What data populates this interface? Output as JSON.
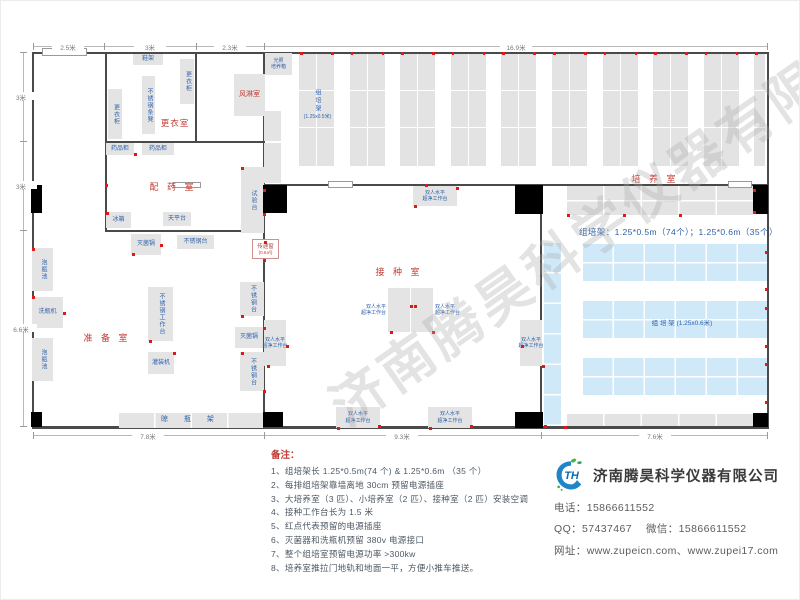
{
  "watermark": "济南腾昊科学仪器有限公司",
  "logo_text": "TH",
  "plan": {
    "walls": [
      [
        31,
        51,
        737,
        2
      ],
      [
        31,
        51,
        2,
        377
      ],
      [
        766,
        51,
        2,
        377
      ],
      [
        31,
        425,
        737,
        3
      ],
      [
        104,
        51,
        1.5,
        180
      ],
      [
        194,
        51,
        1.5,
        90
      ],
      [
        262,
        51,
        2,
        376
      ],
      [
        104,
        140,
        159,
        1.5
      ],
      [
        104,
        229,
        159,
        1.5
      ],
      [
        262,
        183,
        279,
        2
      ],
      [
        539,
        183,
        2,
        244
      ],
      [
        541,
        183,
        226,
        2
      ]
    ],
    "doors": [
      [
        41,
        47,
        45,
        8
      ],
      [
        327,
        180,
        25,
        7
      ],
      [
        727,
        180,
        24,
        7
      ],
      [
        172,
        181,
        28,
        6
      ]
    ],
    "columns": [
      [
        30,
        184,
        11,
        28
      ],
      [
        262,
        184,
        24,
        28
      ],
      [
        514,
        184,
        28,
        29
      ],
      [
        752,
        184,
        15,
        29
      ],
      [
        30,
        411,
        11,
        15
      ],
      [
        262,
        411,
        20,
        15
      ],
      [
        514,
        411,
        28,
        16
      ],
      [
        752,
        412,
        15,
        14
      ]
    ],
    "room_labels": [
      {
        "text": "更衣室",
        "x": 174,
        "y": 121,
        "fs": 8.5,
        "ls": 1
      },
      {
        "text": "配 药 室",
        "x": 172,
        "y": 184,
        "fs": 9,
        "ls": 3
      },
      {
        "text": "准 备 室",
        "x": 106,
        "y": 335,
        "fs": 9,
        "ls": 3
      },
      {
        "text": "接 种 室",
        "x": 398,
        "y": 269,
        "fs": 9,
        "ls": 3
      },
      {
        "text": "培 养 室",
        "x": 654,
        "y": 176,
        "fs": 9,
        "ls": 3
      }
    ],
    "equipment": [
      {
        "label": "鞋架",
        "x": 132,
        "y": 53,
        "w": 30,
        "h": 11
      },
      {
        "label": "更衣柜",
        "x": 179,
        "y": 58,
        "w": 14,
        "h": 45,
        "v": true
      },
      {
        "label": "不锈钢条凳",
        "x": 141,
        "y": 75,
        "w": 13,
        "h": 58,
        "v": true
      },
      {
        "label": "更衣柜",
        "x": 107,
        "y": 88,
        "w": 14,
        "h": 50,
        "v": true
      },
      {
        "label": "风淋室",
        "x": 233,
        "y": 73,
        "w": 31,
        "h": 42,
        "red": true,
        "fs": 7
      },
      {
        "label": "光照\n培养箱",
        "x": 264,
        "y": 52,
        "w": 27,
        "h": 22,
        "fs": 5
      },
      {
        "label": "",
        "x": 263,
        "y": 110,
        "w": 17,
        "h": 30
      },
      {
        "label": "",
        "x": 263,
        "y": 142,
        "w": 17,
        "h": 40
      },
      {
        "label": "药品柜",
        "x": 105,
        "y": 142,
        "w": 28,
        "h": 12
      },
      {
        "label": "药品柜",
        "x": 141,
        "y": 142,
        "w": 32,
        "h": 12
      },
      {
        "label": "试验台",
        "x": 240,
        "y": 166,
        "w": 23,
        "h": 66,
        "v": true
      },
      {
        "label": "冰箱",
        "x": 105,
        "y": 211,
        "w": 25,
        "h": 16
      },
      {
        "label": "天平台",
        "x": 162,
        "y": 211,
        "w": 28,
        "h": 14
      },
      {
        "label": "灭菌锅",
        "x": 130,
        "y": 233,
        "w": 30,
        "h": 21
      },
      {
        "label": "不锈钢台",
        "x": 176,
        "y": 234,
        "w": 37,
        "h": 14
      },
      {
        "label": "泡瓶池",
        "x": 31,
        "y": 247,
        "w": 21,
        "h": 43,
        "v": true
      },
      {
        "label": "洗瓶机",
        "x": 31,
        "y": 296,
        "w": 31,
        "h": 31
      },
      {
        "label": "泡瓶池",
        "x": 31,
        "y": 337,
        "w": 21,
        "h": 43,
        "v": true
      },
      {
        "label": "不锈钢工作台",
        "x": 147,
        "y": 286,
        "w": 25,
        "h": 54,
        "v": true
      },
      {
        "label": "灌装机",
        "x": 147,
        "y": 351,
        "w": 26,
        "h": 22
      },
      {
        "label": "不锈钢台",
        "x": 239,
        "y": 281,
        "w": 24,
        "h": 34,
        "v": true
      },
      {
        "label": "灭菌锅",
        "x": 234,
        "y": 326,
        "w": 28,
        "h": 21
      },
      {
        "label": "不锈钢台",
        "x": 239,
        "y": 351,
        "w": 24,
        "h": 39,
        "v": true
      },
      {
        "label": "晾 瓶 架",
        "x": 118,
        "y": 412,
        "w": 144,
        "h": 15,
        "shelf": true,
        "fs": 7
      },
      {
        "label": "双人水平\n超净工作台",
        "x": 412,
        "y": 185,
        "w": 44,
        "h": 20,
        "fs": 5
      },
      {
        "label": "双人水平\n超净工作台",
        "x": 387,
        "y": 287,
        "w": 22,
        "h": 44,
        "mode": "left",
        "fs": 5
      },
      {
        "label": "双人水平\n超净工作台",
        "x": 410,
        "y": 287,
        "w": 22,
        "h": 44,
        "mode": "right",
        "fs": 5
      },
      {
        "label": "双人水平\n超净工作台",
        "x": 263,
        "y": 319,
        "w": 22,
        "h": 46,
        "mode": "spill",
        "fs": 5
      },
      {
        "label": "双人水平\n超净工作台",
        "x": 519,
        "y": 319,
        "w": 22,
        "h": 46,
        "mode": "spill",
        "fs": 5
      },
      {
        "label": "双人水平\n超净工作台",
        "x": 335,
        "y": 406,
        "w": 44,
        "h": 21,
        "fs": 5
      },
      {
        "label": "双人水平\n超净工作台",
        "x": 427,
        "y": 406,
        "w": 44,
        "h": 21,
        "fs": 5
      }
    ],
    "pass_window": {
      "label": "传递窗",
      "size": "(0.6㎡)",
      "x": 251,
      "y": 238,
      "w": 27,
      "h": 20
    },
    "strips": {
      "count": 10,
      "x0": 298,
      "pitch": 50.6,
      "w": 35,
      "y": 53,
      "h": 112,
      "clip": 764
    },
    "strip_label": {
      "title": "组培架",
      "size": "(1.25x0.5米)",
      "x": 298,
      "y": 88,
      "w": 37
    },
    "rack_info": {
      "text": "组培架：1.25*0.5m（74个）；1.25*0.6m（35个）",
      "x": 578,
      "y": 225
    },
    "right_section": {
      "gray_top": [
        566,
        185,
        186,
        29
      ],
      "gray_bottom": [
        566,
        413,
        186,
        13
      ],
      "blue_strip": [
        543,
        242,
        17,
        183
      ],
      "blue_blocks": [
        [
          582,
          243,
          184,
          37
        ],
        [
          582,
          300,
          184,
          37
        ],
        [
          582,
          357,
          184,
          37
        ]
      ],
      "blue_label": {
        "text": "组 培 架 (1.25x0.6米)",
        "x": 681,
        "y": 320
      }
    },
    "dims": {
      "top": {
        "y": 45,
        "from": 32,
        "to": 766,
        "ticks": [
          32,
          103,
          195,
          263,
          766
        ],
        "labels": [
          {
            "text": "2.5米",
            "pos": 67
          },
          {
            "text": "3米",
            "pos": 149
          },
          {
            "text": "2.3米",
            "pos": 229
          },
          {
            "text": "16.9米",
            "pos": 515
          }
        ]
      },
      "left": {
        "x": 22,
        "from": 51,
        "to": 425,
        "ticks": [
          51,
          140,
          229,
          425
        ],
        "labels": [
          {
            "text": "3米",
            "pos": 95
          },
          {
            "text": "3米",
            "pos": 184
          },
          {
            "text": "6.6米",
            "pos": 327
          }
        ]
      },
      "bottom": {
        "y": 434,
        "from": 32,
        "to": 766,
        "ticks": [
          32,
          263,
          540,
          766
        ],
        "labels": [
          {
            "text": "7.8米",
            "pos": 147
          },
          {
            "text": "9.3米",
            "pos": 401
          },
          {
            "text": "7.6米",
            "pos": 654
          }
        ]
      }
    },
    "dots": [
      [
        104,
        183
      ],
      [
        105,
        211
      ],
      [
        133,
        152
      ],
      [
        240,
        166
      ],
      [
        262,
        188
      ],
      [
        262,
        212
      ],
      [
        263,
        240
      ],
      [
        262,
        258
      ],
      [
        31,
        247
      ],
      [
        31,
        295
      ],
      [
        31,
        327
      ],
      [
        62,
        311
      ],
      [
        131,
        252
      ],
      [
        159,
        243
      ],
      [
        148,
        339
      ],
      [
        172,
        351
      ],
      [
        240,
        314
      ],
      [
        262,
        326
      ],
      [
        240,
        351
      ],
      [
        262,
        389
      ],
      [
        266,
        364
      ],
      [
        389,
        330
      ],
      [
        409,
        304
      ],
      [
        413,
        304
      ],
      [
        431,
        330
      ],
      [
        285,
        344
      ],
      [
        520,
        344
      ],
      [
        541,
        364
      ],
      [
        336,
        426
      ],
      [
        377,
        424
      ],
      [
        428,
        426
      ],
      [
        469,
        424
      ],
      [
        413,
        204
      ],
      [
        455,
        186
      ],
      [
        424,
        183
      ],
      [
        543,
        424
      ],
      [
        563,
        425
      ],
      [
        752,
        188
      ],
      [
        752,
        210
      ],
      [
        764,
        250
      ],
      [
        764,
        287
      ],
      [
        764,
        306
      ],
      [
        764,
        344
      ],
      [
        764,
        362
      ],
      [
        764,
        400
      ],
      [
        566,
        213
      ],
      [
        622,
        213
      ],
      [
        678,
        213
      ]
    ]
  },
  "notes": {
    "title": "备注：",
    "items": [
      "1、组培架长 1.25*0.5m(74 个) & 1.25*0.6m （35 个）",
      "2、每排组培架靠墙离地 30cm 预留电源插座",
      "3、大培养室（3 匹）、小培养室（2 匹）、接种室（2 匹）安装空调",
      "4、接种工作台长为 1.5 米",
      "5、红点代表预留的电源插座",
      "6、灭菌器和洗瓶机预留 380v 电源接口",
      "7、整个组培室预留电源功率 >300kw",
      "8、培养室推拉门地轨和地面一平，方便小推车推送。"
    ]
  },
  "contact": {
    "name": "济南腾昊科学仪器有限公司",
    "phone_label": "电话：",
    "phone": "15866611552",
    "qq_label": "QQ：",
    "qq": "57437467",
    "wechat_label": "微信：",
    "wechat": "15866611552",
    "web_label": "网址：",
    "url1": "www.zupeicn.com",
    "url_sep": "、",
    "url2": "www.zupei17.com"
  }
}
